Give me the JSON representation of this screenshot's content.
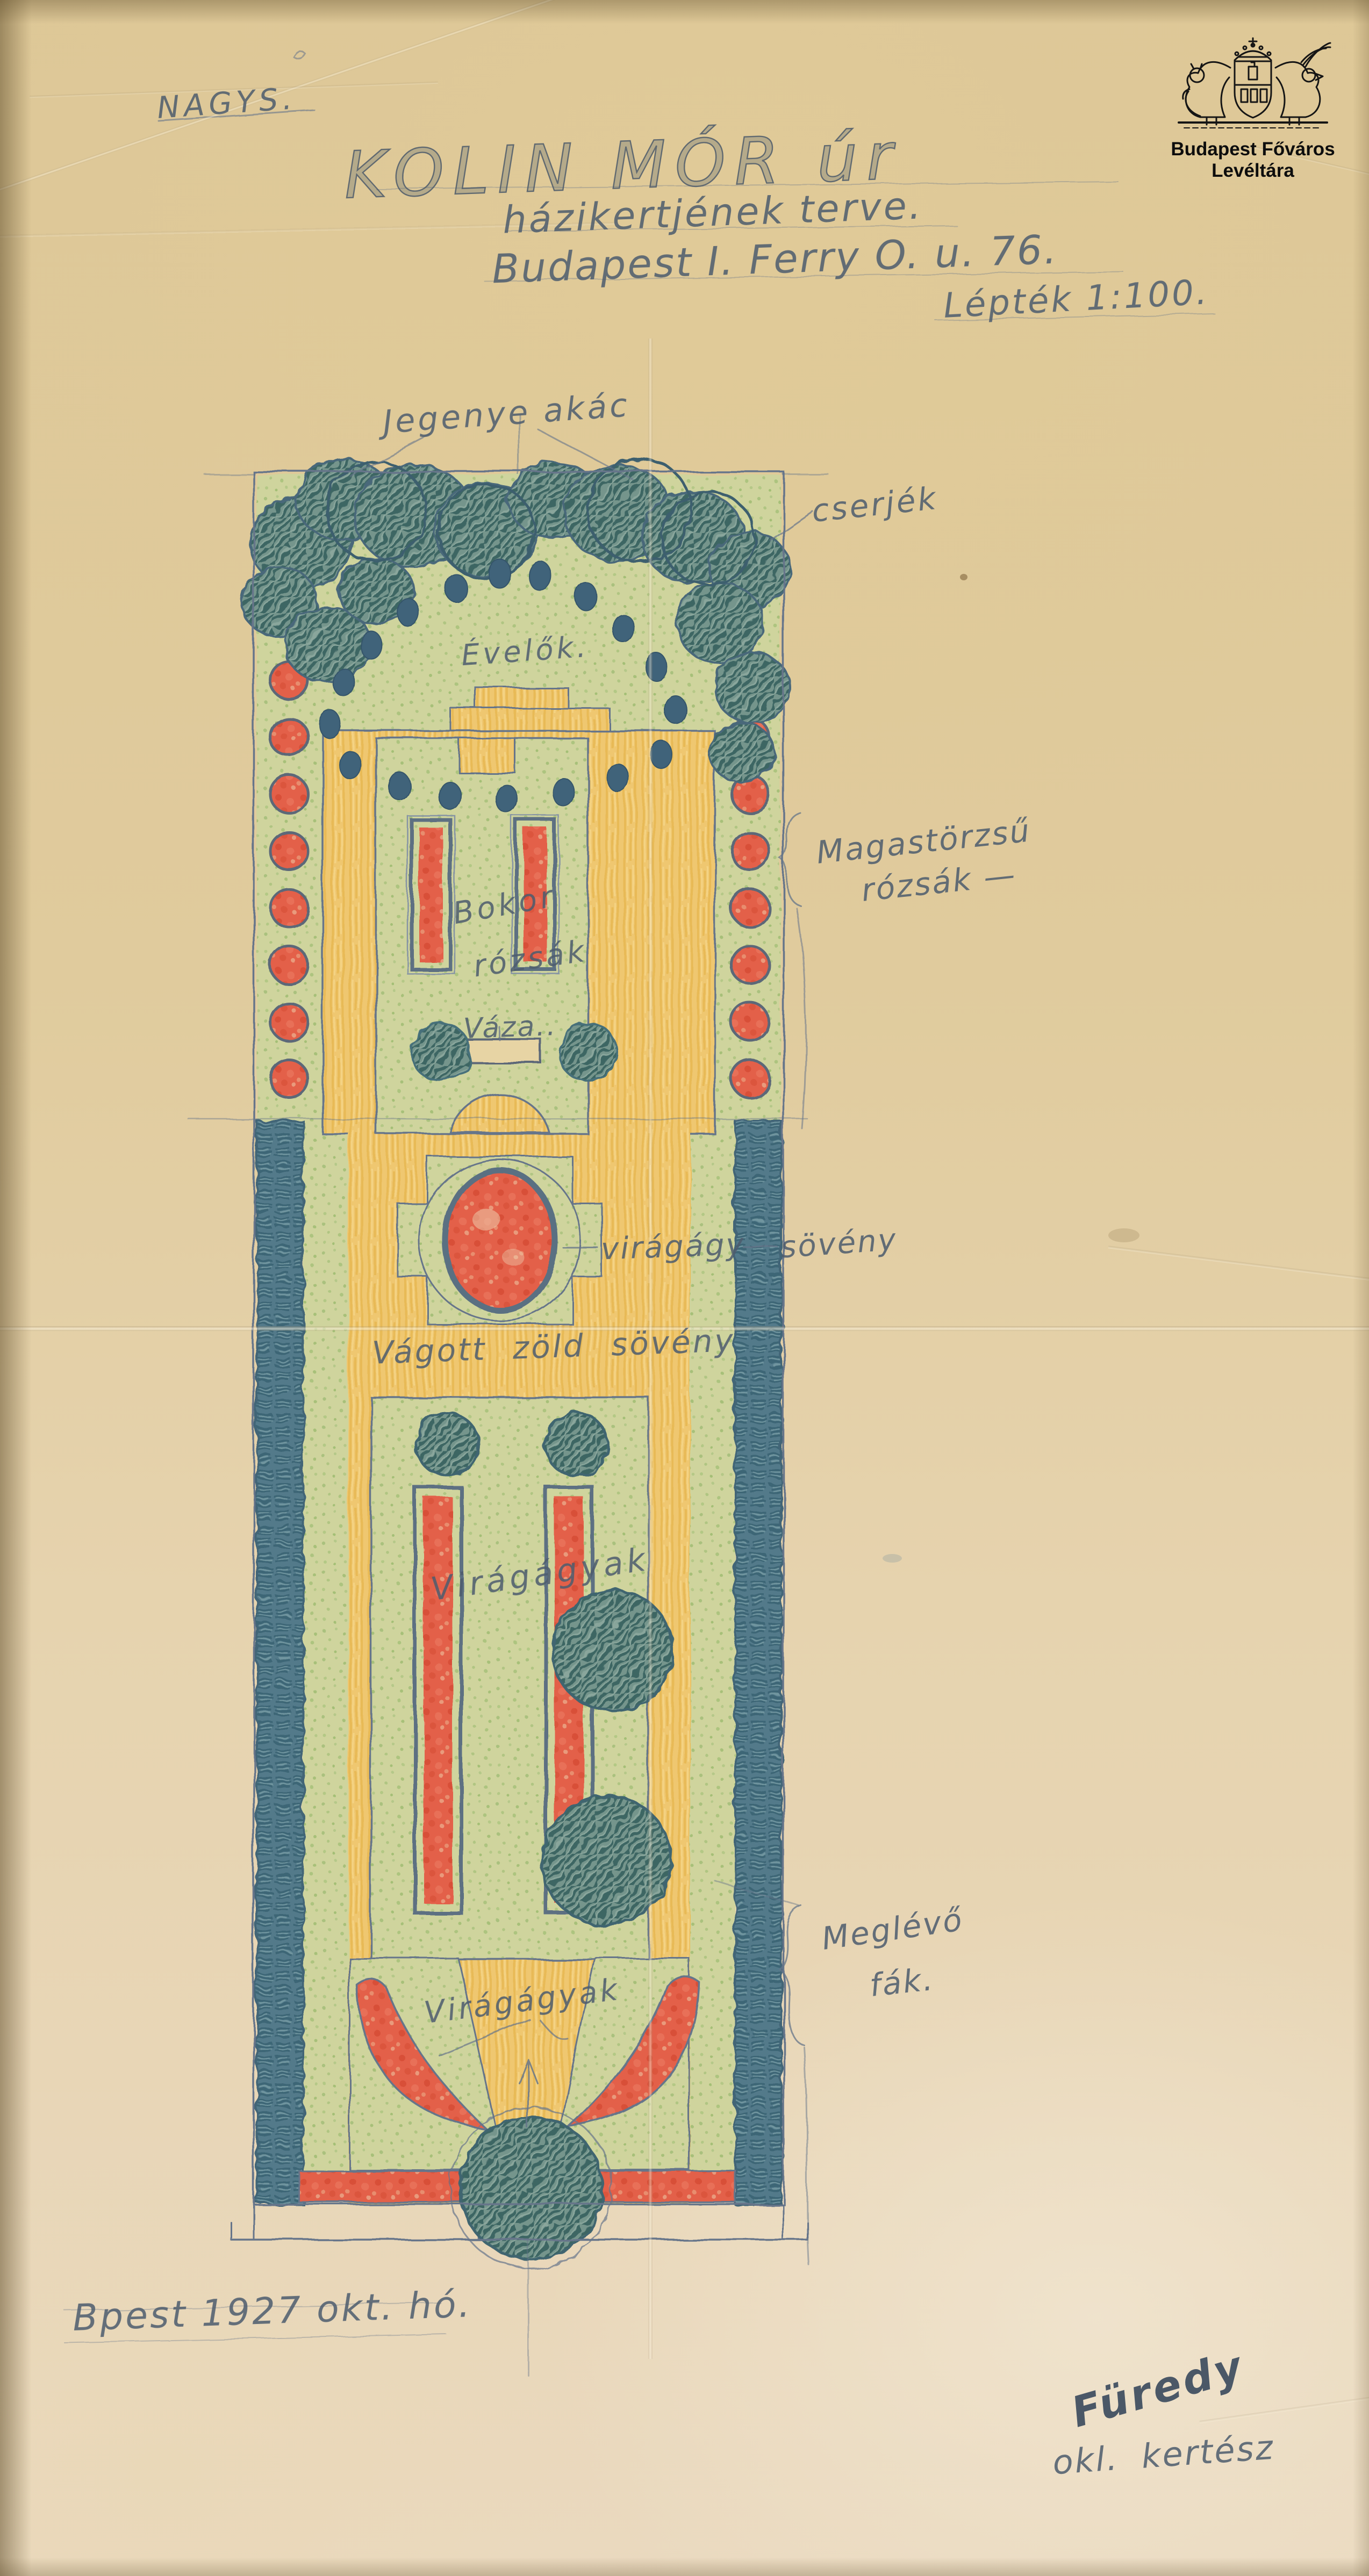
{
  "archive": {
    "name": "Budapest Főváros Levéltára",
    "emblem": "budapest-coat-of-arms-with-lion-and-griffin"
  },
  "header": {
    "annotation": "NAGYS.",
    "title": "KOLIN MÓR úr",
    "subtitle": "házikertjének terve.",
    "address": "Budapest I. Ferry O. u. 76.",
    "scale": "Lépték 1:100."
  },
  "plan_labels": {
    "top_trees": "Jegenye akác",
    "shrubs": "cserjék",
    "perennials": "Évelők.",
    "standard_roses_line1": "Magastörzsű",
    "standard_roses_line2": "rózsák —",
    "bush_roses_line1": "Bokor",
    "bush_roses_line2": "rózsák",
    "vase": "Váza..",
    "flower_bed": "virágágy",
    "hedge": "sövény",
    "cut_hedge": "Vágott zöld sövény",
    "flower_beds_mid": "Virágágyak",
    "existing_trees_line1": "Meglévő",
    "existing_trees_line2": "fák.",
    "flower_beds_lower": "Virágágyak"
  },
  "footer": {
    "date": "Bpest 1927 okt. hó.",
    "signature": "Füredy",
    "signer_title": "okl. kertész"
  },
  "colors": {
    "paper": "#e0cb9d",
    "pencil": "#66758a",
    "lawn_green": "#c9d39b",
    "path_yellow": "#efc76f",
    "bed_red": "#e3604a",
    "hedge_teal": "#527a8a",
    "tree_teal": "#74958c",
    "perennial_dot": "#41637a"
  }
}
